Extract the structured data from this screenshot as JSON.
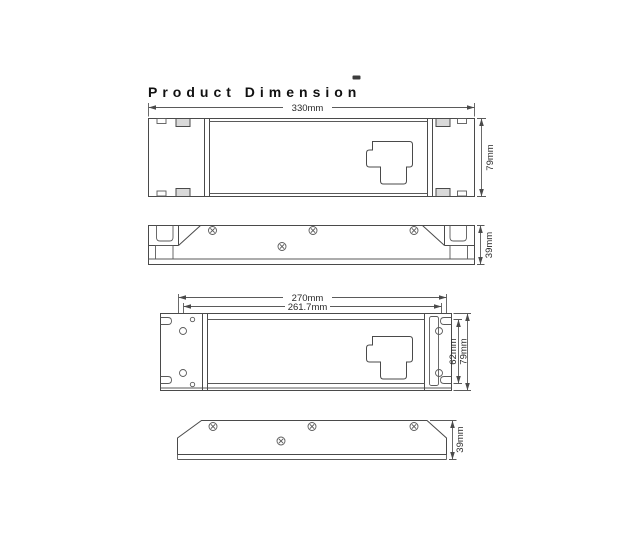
{
  "title": "Product Dimension",
  "colors": {
    "line": "#4a4a4a",
    "dim_text": "#2a2a2a",
    "title_text": "#111111",
    "background": "#ffffff",
    "tab_fill": "#d9d9d9",
    "stray_mark": "#3c3c3c"
  },
  "views": [
    {
      "label": "front-view",
      "dims": {
        "width": "330mm",
        "height": "79mm"
      }
    },
    {
      "label": "side-view",
      "dims": {
        "depth": "39mm"
      }
    },
    {
      "label": "mounting-view",
      "dims": {
        "slot_span": "270mm",
        "hole_span": "261.7mm",
        "inner_height": "62mm",
        "height": "79mm"
      }
    },
    {
      "label": "bottom-side-view",
      "dims": {
        "depth": "39mm"
      }
    }
  ]
}
